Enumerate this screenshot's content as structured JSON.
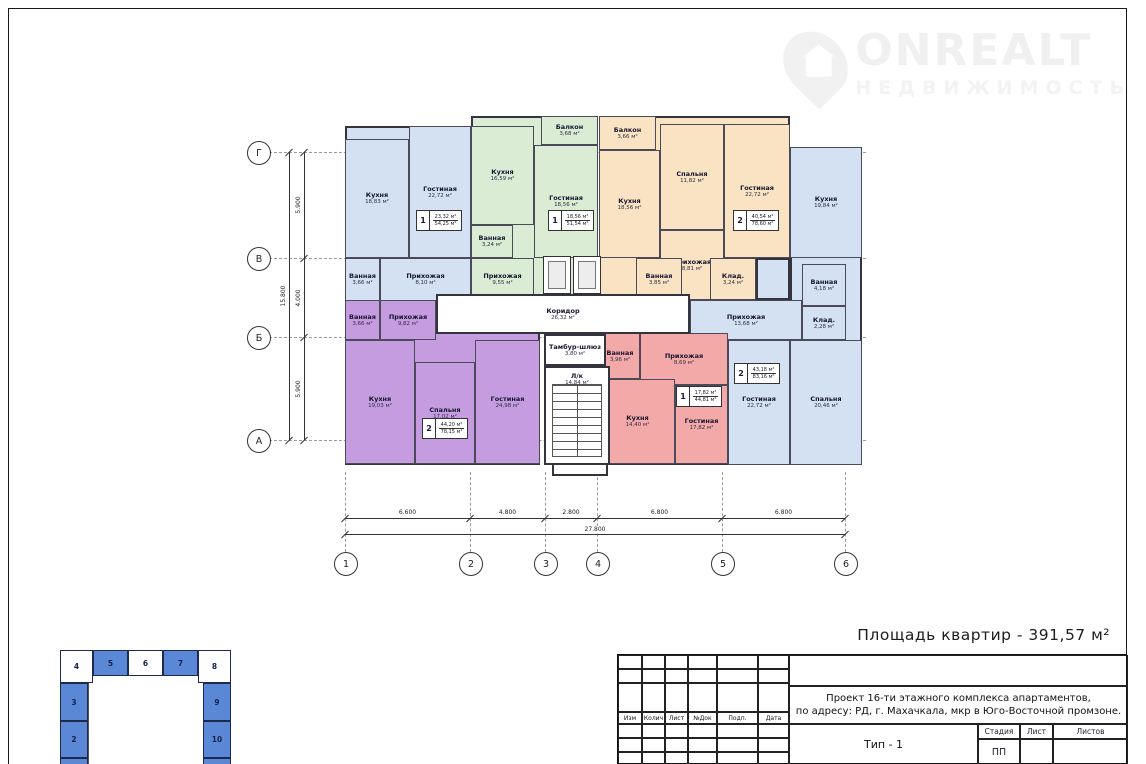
{
  "watermark": {
    "brand": "ONREALT",
    "subtitle": "НЕДВИЖИМОСТЬ"
  },
  "summary_label": "Площадь квартир - 391,57 м²",
  "palette": {
    "blue": "#d3e1f3",
    "green": "#daecd3",
    "orange": "#fae3c3",
    "purple": "#c59ce0",
    "red": "#f4a9a9",
    "white": "#ffffff",
    "wall": "#34343e",
    "keyplan_blue": "#5b87d7"
  },
  "plan": {
    "bgs": [
      {
        "x": 345,
        "y": 126,
        "w": 126,
        "h": 175,
        "c": "blue"
      },
      {
        "x": 471,
        "y": 116,
        "w": 127,
        "h": 185,
        "c": "green"
      },
      {
        "x": 599,
        "y": 116,
        "w": 191,
        "h": 184,
        "c": "orange"
      },
      {
        "x": 790,
        "y": 147,
        "w": 72,
        "h": 318,
        "c": "blue"
      },
      {
        "x": 690,
        "y": 300,
        "w": 100,
        "h": 165,
        "c": "blue"
      },
      {
        "x": 756,
        "y": 258,
        "w": 34,
        "h": 42,
        "c": "blue"
      },
      {
        "x": 345,
        "y": 300,
        "w": 195,
        "h": 165,
        "c": "purple"
      },
      {
        "x": 600,
        "y": 333,
        "w": 128,
        "h": 132,
        "c": "red"
      },
      {
        "x": 552,
        "y": 462,
        "w": 56,
        "h": 14,
        "c": "white"
      }
    ],
    "rooms": [
      {
        "n": "Кухня",
        "a": "18,83 м²",
        "x": 345,
        "y": 139,
        "w": 64,
        "h": 119,
        "c": "blue"
      },
      {
        "n": "Гостиная",
        "a": "22,72 м²",
        "x": 409,
        "y": 126,
        "w": 62,
        "h": 132,
        "c": "blue"
      },
      {
        "n": "Ванная",
        "a": "3,66 м²",
        "x": 345,
        "y": 258,
        "w": 35,
        "h": 43,
        "c": "blue"
      },
      {
        "n": "Прихожая",
        "a": "8,10 м²",
        "x": 380,
        "y": 258,
        "w": 91,
        "h": 43,
        "c": "blue"
      },
      {
        "n": "Балкон",
        "a": "3,68 м²",
        "x": 541,
        "y": 116,
        "w": 57,
        "h": 29,
        "c": "green"
      },
      {
        "n": "Кухня",
        "a": "16,59 м²",
        "x": 471,
        "y": 126,
        "w": 63,
        "h": 99,
        "c": "green"
      },
      {
        "n": "Ванная",
        "a": "3,24 м²",
        "x": 471,
        "y": 225,
        "w": 42,
        "h": 33,
        "c": "green"
      },
      {
        "n": "Гостиная",
        "a": "18,56 м²",
        "x": 534,
        "y": 145,
        "w": 64,
        "h": 113,
        "c": "green"
      },
      {
        "n": "Прихожая",
        "a": "9,55 м²",
        "x": 471,
        "y": 258,
        "w": 63,
        "h": 43,
        "c": "green"
      },
      {
        "n": "Балкон",
        "a": "3,66 м²",
        "x": 599,
        "y": 116,
        "w": 57,
        "h": 34,
        "c": "orange"
      },
      {
        "n": "Кухня",
        "a": "18,56 м²",
        "x": 599,
        "y": 150,
        "w": 61,
        "h": 108,
        "c": "orange"
      },
      {
        "n": "Спальня",
        "a": "11,82 м²",
        "x": 660,
        "y": 124,
        "w": 64,
        "h": 106,
        "c": "orange"
      },
      {
        "n": "Гостиная",
        "a": "22,72 м²",
        "x": 724,
        "y": 124,
        "w": 66,
        "h": 134,
        "c": "orange"
      },
      {
        "n": "Прихожая",
        "a": "8,81 м²",
        "x": 660,
        "y": 230,
        "w": 64,
        "h": 70,
        "c": "orange"
      },
      {
        "n": "Ванная",
        "a": "3,85 м²",
        "x": 636,
        "y": 258,
        "w": 46,
        "h": 42,
        "c": "orange"
      },
      {
        "n": "Клад.",
        "a": "3,24 м²",
        "x": 710,
        "y": 258,
        "w": 46,
        "h": 42,
        "c": "orange"
      },
      {
        "n": "Кухня",
        "a": "19,84 м²",
        "x": 790,
        "y": 147,
        "w": 72,
        "h": 111,
        "c": "blue"
      },
      {
        "n": "Ванная",
        "a": "4,18 м²",
        "x": 802,
        "y": 264,
        "w": 44,
        "h": 42,
        "c": "blue"
      },
      {
        "n": "Клад.",
        "a": "2,28 м²",
        "x": 802,
        "y": 306,
        "w": 44,
        "h": 34,
        "c": "blue"
      },
      {
        "n": "Прихожая",
        "a": "13,68 м²",
        "x": 690,
        "y": 300,
        "w": 112,
        "h": 40,
        "c": "blue"
      },
      {
        "n": "Гостиная",
        "a": "22,72 м²",
        "x": 728,
        "y": 340,
        "w": 62,
        "h": 125,
        "c": "blue"
      },
      {
        "n": "Спальня",
        "a": "20,46 м²",
        "x": 790,
        "y": 340,
        "w": 72,
        "h": 125,
        "c": "blue"
      },
      {
        "n": "Ванная",
        "a": "3,66 м²",
        "x": 345,
        "y": 300,
        "w": 35,
        "h": 40,
        "c": "purple"
      },
      {
        "n": "Прихожая",
        "a": "9,82 м²",
        "x": 380,
        "y": 300,
        "w": 56,
        "h": 40,
        "c": "purple"
      },
      {
        "n": "Кухня",
        "a": "19,03 м²",
        "x": 345,
        "y": 340,
        "w": 70,
        "h": 124,
        "c": "purple"
      },
      {
        "n": "Спальня",
        "a": "17,02 м²",
        "x": 415,
        "y": 362,
        "w": 60,
        "h": 102,
        "c": "purple"
      },
      {
        "n": "Гостиная",
        "a": "24,98 м²",
        "x": 475,
        "y": 340,
        "w": 65,
        "h": 124,
        "c": "purple"
      },
      {
        "n": "Ванная",
        "a": "3,96 м²",
        "x": 600,
        "y": 333,
        "w": 40,
        "h": 46,
        "c": "red"
      },
      {
        "n": "Прихожая",
        "a": "8,69 м²",
        "x": 640,
        "y": 333,
        "w": 88,
        "h": 52,
        "c": "red"
      },
      {
        "n": "Кухня",
        "a": "14,40 м²",
        "x": 600,
        "y": 379,
        "w": 75,
        "h": 85,
        "c": "red"
      },
      {
        "n": "Гостиная",
        "a": "17,82 м²",
        "x": 675,
        "y": 385,
        "w": 53,
        "h": 79,
        "c": "red"
      },
      {
        "n": "Коридор",
        "a": "26,32 м²",
        "x": 436,
        "y": 294,
        "w": 254,
        "h": 40,
        "c": "white"
      },
      {
        "n": "Тамбур-шлюз",
        "a": "3,80 м²",
        "x": 544,
        "y": 334,
        "w": 62,
        "h": 32,
        "c": "white"
      },
      {
        "n": "Л/к",
        "a": "14,84 м²",
        "x": 544,
        "y": 366,
        "w": 66,
        "h": 99,
        "c": "white",
        "stairs": true
      }
    ],
    "stamps": [
      {
        "num": "1",
        "upper": "23,32 м²",
        "lower": "54,25 м²",
        "x": 416,
        "y": 210
      },
      {
        "num": "1",
        "upper": "18,56 м²",
        "lower": "51,54 м²",
        "x": 548,
        "y": 210
      },
      {
        "num": "2",
        "upper": "40,54 м²",
        "lower": "78,60 м²",
        "x": 733,
        "y": 210
      },
      {
        "num": "2",
        "upper": "43,18 м²",
        "lower": "83,16 м²",
        "x": 734,
        "y": 363
      },
      {
        "num": "2",
        "upper": "44,20 м²",
        "lower": "78,15 м²",
        "x": 422,
        "y": 418
      },
      {
        "num": "1",
        "upper": "17,82 м²",
        "lower": "44,81 м²",
        "x": 676,
        "y": 386
      }
    ],
    "elevators": [
      {
        "x": 543,
        "y": 256,
        "w": 28,
        "h": 38
      },
      {
        "x": 573,
        "y": 256,
        "w": 28,
        "h": 38
      }
    ],
    "row_axes": [
      {
        "label": "Г",
        "y": 152
      },
      {
        "label": "В",
        "y": 258
      },
      {
        "label": "Б",
        "y": 337
      },
      {
        "label": "А",
        "y": 440
      }
    ],
    "col_axes": [
      {
        "label": "1",
        "x": 345
      },
      {
        "label": "2",
        "x": 470
      },
      {
        "label": "3",
        "x": 545
      },
      {
        "label": "4",
        "x": 597
      },
      {
        "label": "5",
        "x": 722
      },
      {
        "label": "6",
        "x": 845
      }
    ],
    "h_dims": [
      {
        "t": "6.600",
        "x1": 345,
        "x2": 470
      },
      {
        "t": "4.800",
        "x1": 470,
        "x2": 545
      },
      {
        "t": "2.800",
        "x1": 545,
        "x2": 597
      },
      {
        "t": "6.800",
        "x1": 597,
        "x2": 722
      },
      {
        "t": "6.800",
        "x1": 722,
        "x2": 845
      }
    ],
    "h_total": "27.800",
    "v_dims": [
      {
        "t": "5.900",
        "y1": 152,
        "y2": 258
      },
      {
        "t": "4.000",
        "y1": 258,
        "y2": 337
      },
      {
        "t": "5.900",
        "y1": 337,
        "y2": 440
      }
    ],
    "v_total": "15.800"
  },
  "key_plan": {
    "cells": [
      {
        "label": "4",
        "x": 60,
        "y": 650,
        "w": 33,
        "h": 33,
        "filled": false
      },
      {
        "label": "5",
        "x": 93,
        "y": 650,
        "w": 35,
        "h": 26,
        "filled": true
      },
      {
        "label": "6",
        "x": 128,
        "y": 650,
        "w": 35,
        "h": 26,
        "filled": false
      },
      {
        "label": "7",
        "x": 163,
        "y": 650,
        "w": 35,
        "h": 26,
        "filled": true
      },
      {
        "label": "8",
        "x": 198,
        "y": 650,
        "w": 33,
        "h": 33,
        "filled": false
      },
      {
        "label": "3",
        "x": 60,
        "y": 683,
        "w": 28,
        "h": 38,
        "filled": true
      },
      {
        "label": "2",
        "x": 60,
        "y": 721,
        "w": 28,
        "h": 37,
        "filled": true
      },
      {
        "label": "",
        "x": 60,
        "y": 758,
        "w": 28,
        "h": 7,
        "filled": true
      },
      {
        "label": "9",
        "x": 203,
        "y": 683,
        "w": 28,
        "h": 38,
        "filled": true
      },
      {
        "label": "10",
        "x": 203,
        "y": 721,
        "w": 28,
        "h": 37,
        "filled": true
      },
      {
        "label": "",
        "x": 203,
        "y": 758,
        "w": 28,
        "h": 7,
        "filled": true
      }
    ]
  },
  "title_block": {
    "rev_cols": [
      "Изм",
      "Колич",
      "Лист",
      "№Док",
      "Подп.",
      "Дата"
    ],
    "project_line1": "Проект 16-ти этажного комплекса апартаментов,",
    "project_line2": "по адресу: РД, г. Махачкала, мкр в Юго-Восточной промзоне.",
    "type_label": "Тип - 1",
    "stage_cols": [
      "Стадия",
      "Лист",
      "Листов"
    ],
    "stage_value": "ПП"
  }
}
